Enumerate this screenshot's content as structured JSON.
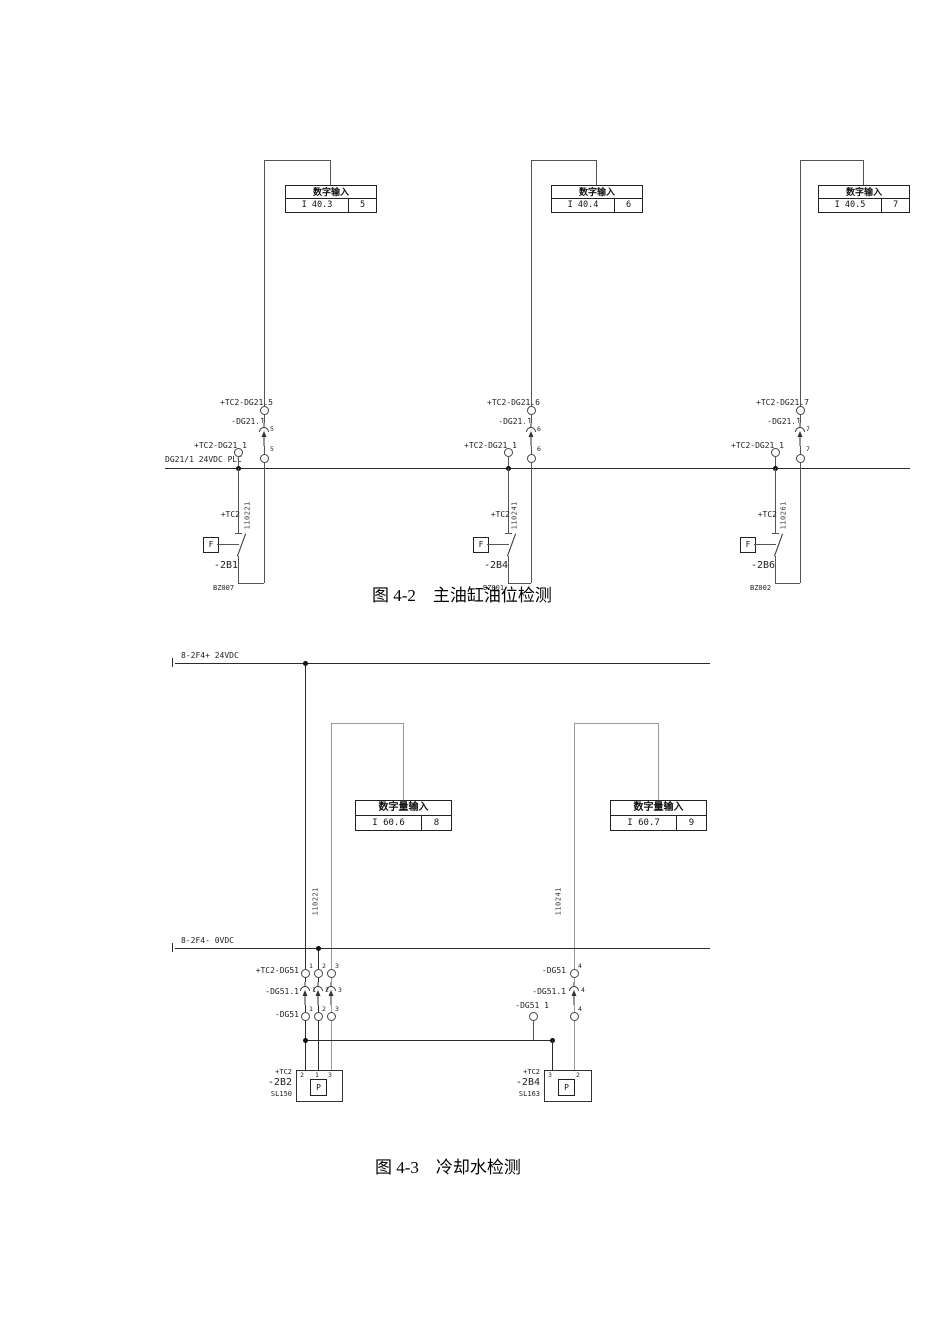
{
  "figure_4_2": {
    "caption": "图 4-2　主油缸油位检测",
    "bus_label": "DG21/1 24VDC PLC",
    "branches": [
      {
        "box_title": "数字输入",
        "address": "I 40.3",
        "channel": "5",
        "terminal_label": "+TC2-DG21.5",
        "connector_label": "-DG21.1",
        "connector_pin": "5",
        "lower_pin": "5",
        "bus_terminal_label": "+TC2-DG21 1",
        "plant_label": "+TC2",
        "switch_function": "F",
        "device_tag": "-2B1",
        "wire_number": "110221",
        "ref_label": "BZ007"
      },
      {
        "box_title": "数字输入",
        "address": "I 40.4",
        "channel": "6",
        "terminal_label": "+TC2-DG21.6",
        "connector_label": "-DG21.1",
        "connector_pin": "6",
        "lower_pin": "6",
        "bus_terminal_label": "+TC2-DG21 1",
        "plant_label": "+TC2",
        "switch_function": "F",
        "device_tag": "-2B4",
        "wire_number": "110241",
        "ref_label": "BZ001"
      },
      {
        "box_title": "数字输入",
        "address": "I 40.5",
        "channel": "7",
        "terminal_label": "+TC2-DG21.7",
        "connector_label": "-DG21.1",
        "connector_pin": "7",
        "lower_pin": "7",
        "bus_terminal_label": "+TC2-DG21 1",
        "plant_label": "+TC2",
        "switch_function": "F",
        "device_tag": "-2B6",
        "wire_number": "110261",
        "ref_label": "BZ002"
      }
    ]
  },
  "figure_4_3": {
    "caption": "图 4-3　冷却水检测",
    "top_bus_label": "8-2F4+ 24VDC",
    "bottom_bus_label": "8-2F4- 0VDC",
    "plc_inputs": [
      {
        "box_title": "数字量输入",
        "address": "I 60.6",
        "channel": "8",
        "wire_number": "110221"
      },
      {
        "box_title": "数字量输入",
        "address": "I 60.7",
        "channel": "9",
        "wire_number": "110241"
      }
    ],
    "left_group": {
      "terminal_row_label": "+TC2-DG51",
      "connector_row_label": "-DG51.1",
      "lower_row_label": "-DG51",
      "pins": [
        "1",
        "2",
        "3"
      ],
      "device": {
        "plant_label": "+TC2",
        "tag": "-2B2",
        "code": "SL150",
        "function": "P",
        "terminals": [
          "2",
          "1",
          "3"
        ]
      }
    },
    "right_group": {
      "terminal_row_label": "-DG51",
      "connector_row_label": "-DG51.1",
      "pin": "4",
      "link_terminal_label": "-DG51 1",
      "device": {
        "plant_label": "+TC2",
        "tag": "-2B4",
        "code": "SL163",
        "function": "P",
        "terminals": [
          "3",
          "2"
        ]
      }
    }
  }
}
